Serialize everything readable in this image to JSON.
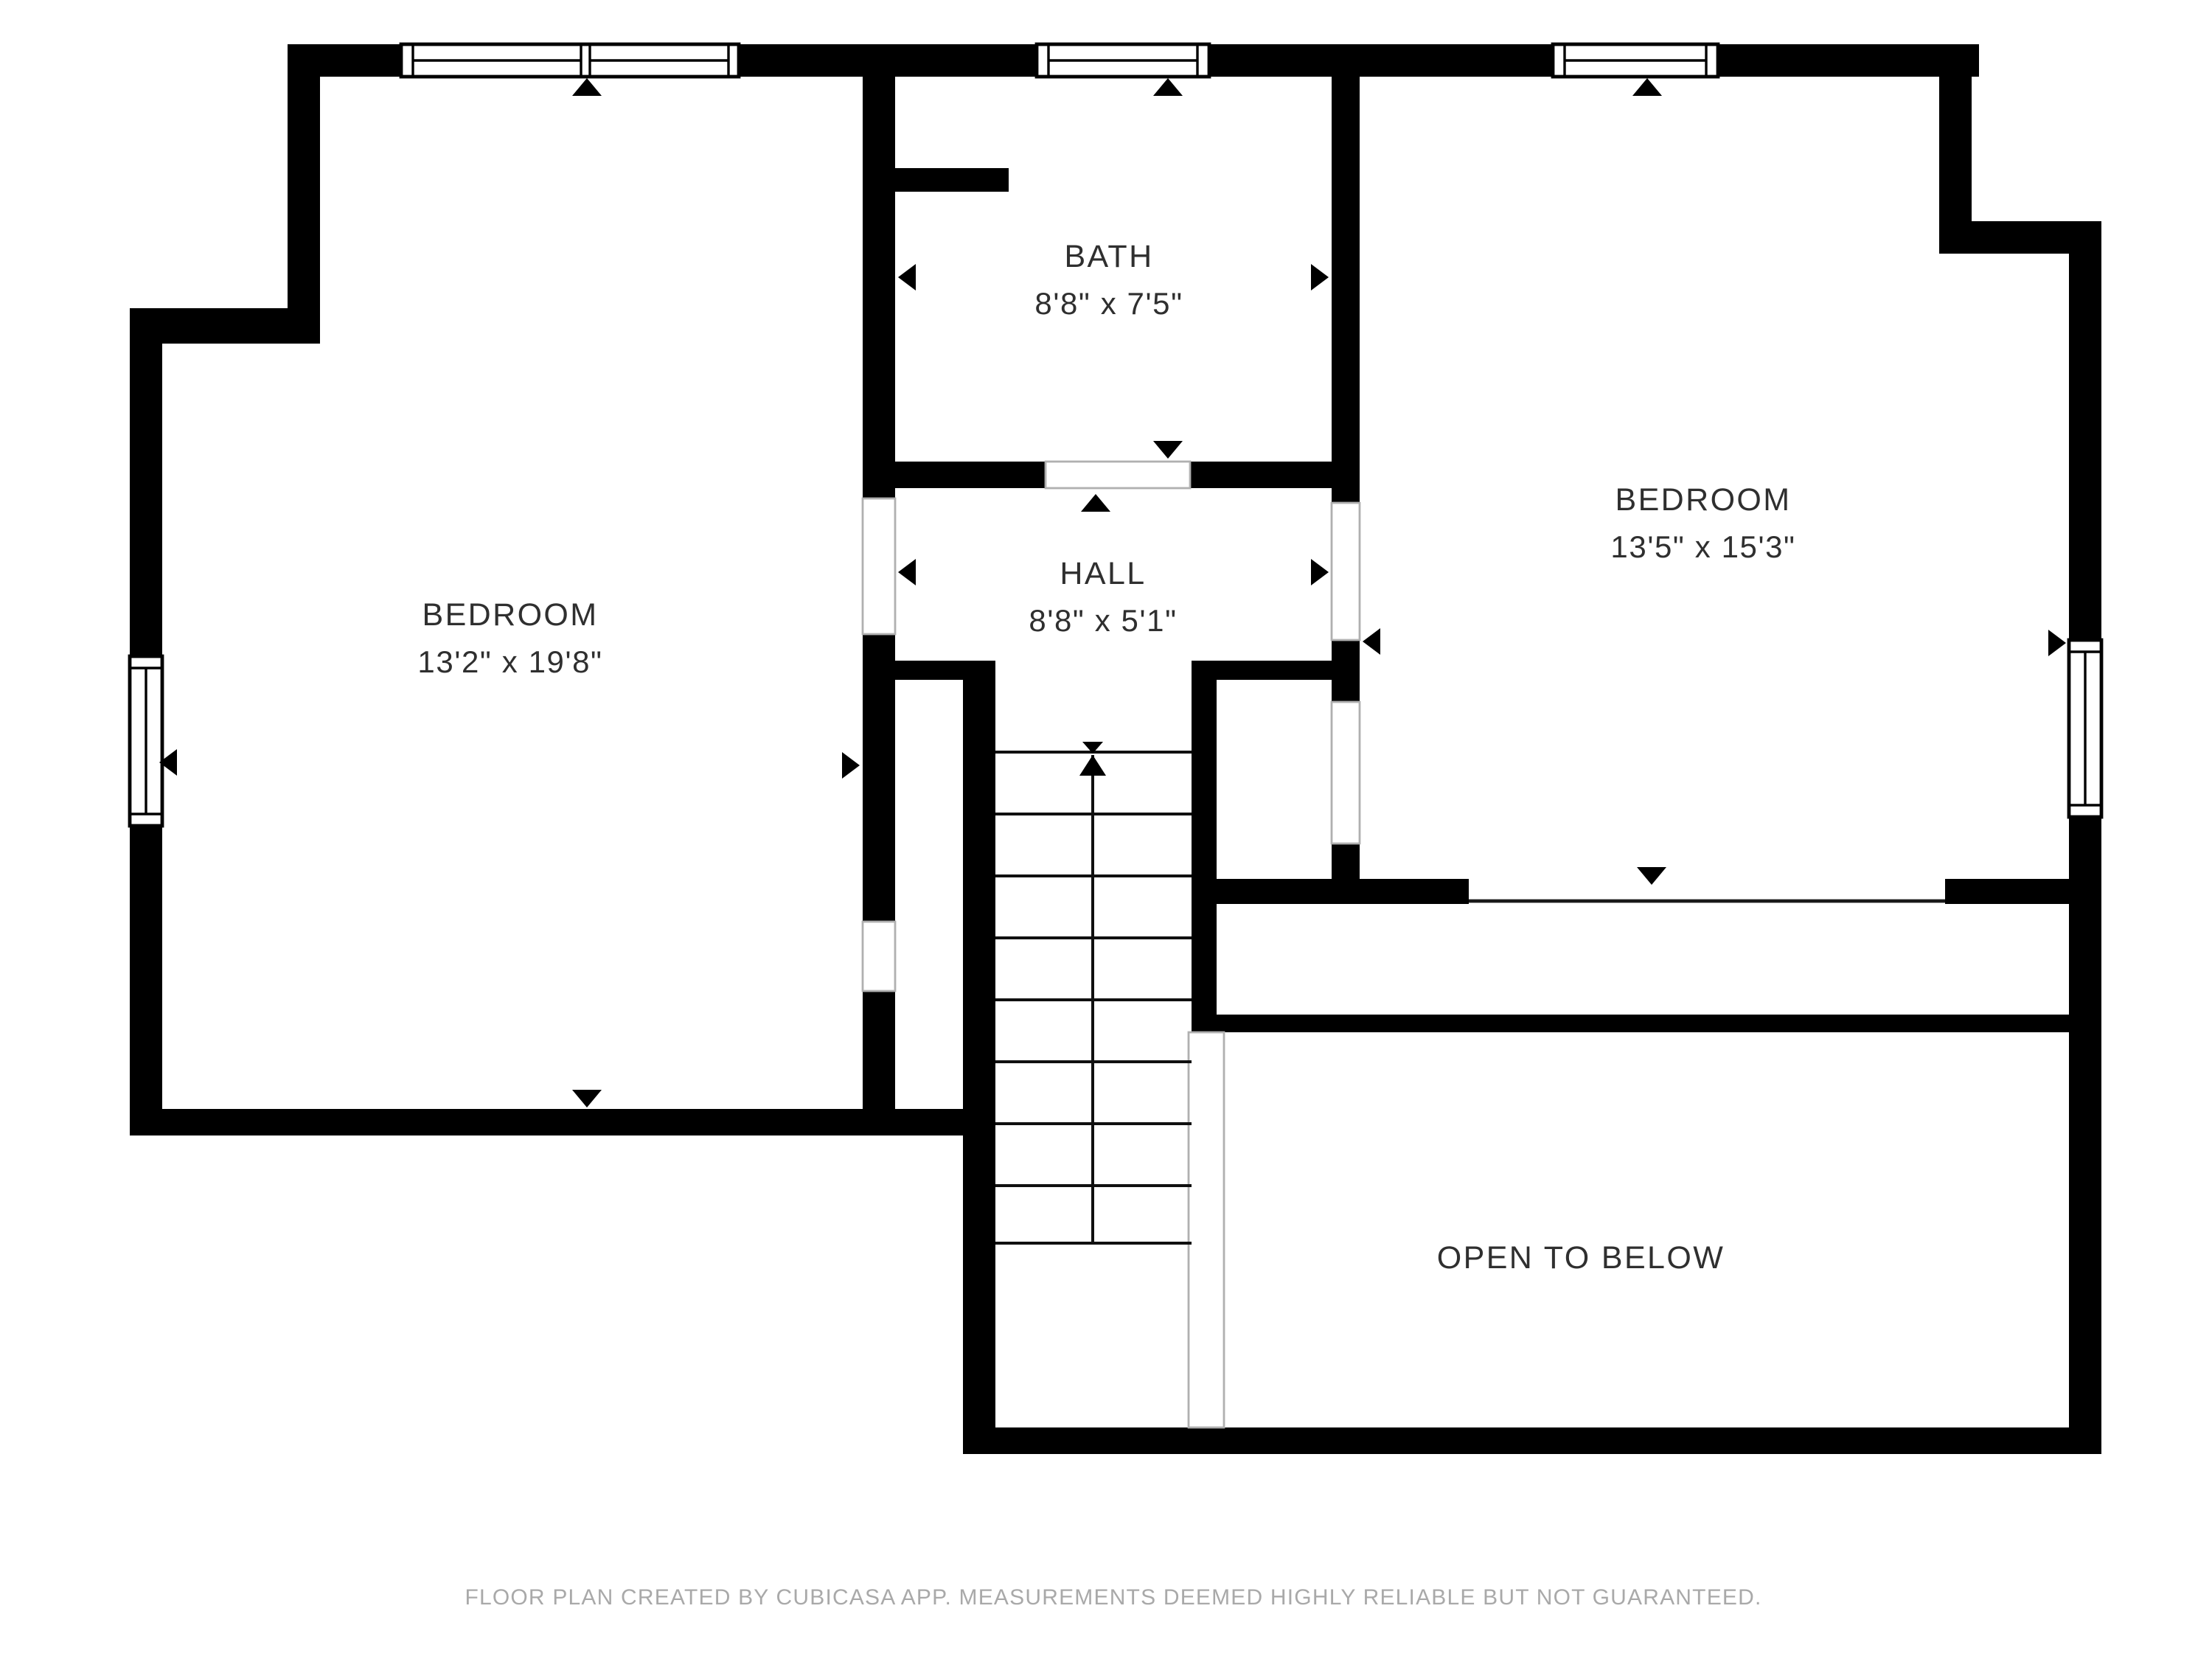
{
  "plan": {
    "rooms": [
      {
        "name": "BEDROOM",
        "dimensions": "13'2\" x 19'8\""
      },
      {
        "name": "BATH",
        "dimensions": "8'8\" x 7'5\""
      },
      {
        "name": "HALL",
        "dimensions": "8'8\" x 5'1\""
      },
      {
        "name": "BEDROOM",
        "dimensions": "13'5\" x 15'3\""
      },
      {
        "name": "OPEN TO BELOW",
        "dimensions": ""
      }
    ],
    "stairs": {
      "direction": "up",
      "visible_treads": 8
    },
    "colors": {
      "wall": "#000000",
      "room_label": "#2f2f2f",
      "footer_text": "#a9a9a9",
      "door_jamb": "#b0b0b0",
      "background": "#ffffff"
    },
    "icons": [
      "window-icon",
      "door-opening",
      "stair-up-arrow-icon",
      "measure-arrow-icon",
      "opening-marker-icon"
    ]
  },
  "footer": {
    "text": "FLOOR PLAN CREATED BY CUBICASA APP. MEASUREMENTS DEEMED HIGHLY RELIABLE BUT NOT GUARANTEED."
  }
}
